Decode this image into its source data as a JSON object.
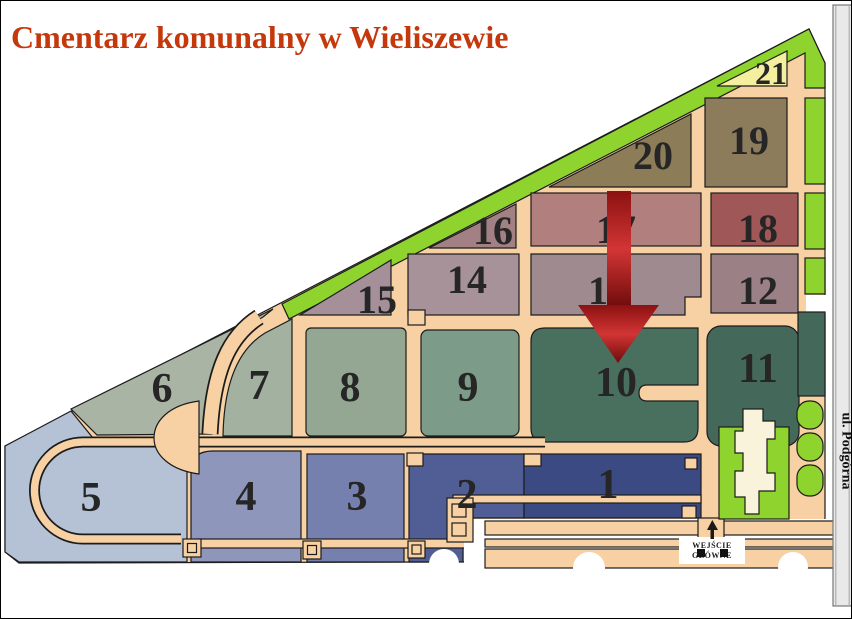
{
  "title": {
    "text": "Cmentarz komunalny w Wieliszewie",
    "color": "#c4380c"
  },
  "street": {
    "label": "ul. Podgórna"
  },
  "entrance": {
    "line1": "WEJŚCIE",
    "line2": "GŁÓWNE"
  },
  "map": {
    "path_color": "#f7d1a3",
    "border_green": "#8fd42e",
    "chapel_color": "#f8f3da",
    "outline_color": "#1c1c1c",
    "street_bar_color": "#e9e9e9"
  },
  "arrow": {
    "points_to_section": "10",
    "color_top": "#8c1111",
    "color_mid": "#d23535",
    "color_tip": "#6d0b0b"
  },
  "sections": {
    "s1": {
      "label": "1",
      "color": "#3b4a82"
    },
    "s2": {
      "label": "2",
      "color": "#515e96"
    },
    "s3": {
      "label": "3",
      "color": "#7680ae"
    },
    "s4": {
      "label": "4",
      "color": "#8f96bc"
    },
    "s5": {
      "label": "5",
      "color": "#b5c2d5"
    },
    "s6": {
      "label": "6",
      "color": "#a9b4a4"
    },
    "s7": {
      "label": "7",
      "color": "#a3b1a1"
    },
    "s8": {
      "label": "8",
      "color": "#93a792"
    },
    "s9": {
      "label": "9",
      "color": "#7d9b89"
    },
    "s10": {
      "label": "10",
      "color": "#49705f"
    },
    "s11": {
      "label": "11",
      "color": "#44685a"
    },
    "s12": {
      "label": "12",
      "color": "#9b8186"
    },
    "s13": {
      "label": "13",
      "color": "#9f8a8f"
    },
    "s14": {
      "label": "14",
      "color": "#a8929a"
    },
    "s15": {
      "label": "15",
      "color": "#a5909a"
    },
    "s16": {
      "label": "16",
      "color": "#a28084"
    },
    "s17": {
      "label": "17",
      "color": "#b27f7f"
    },
    "s18": {
      "label": "18",
      "color": "#9f5757"
    },
    "s19": {
      "label": "19",
      "color": "#8d7c5c"
    },
    "s20": {
      "label": "20",
      "color": "#8d7c58"
    },
    "s21": {
      "label": "21",
      "color": "#f4ee9f"
    }
  }
}
